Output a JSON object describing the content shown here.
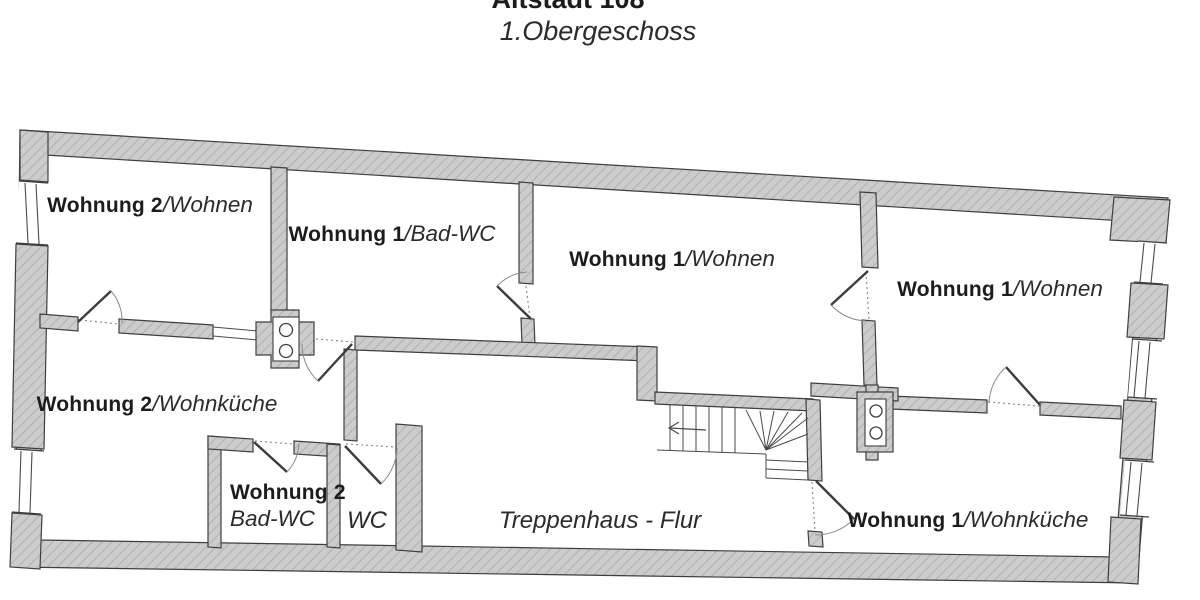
{
  "header": {
    "project_title": "Altstadt 108",
    "floor_title": "1.Obergeschoss"
  },
  "rooms": [
    {
      "id": "wohnung2-wohnen",
      "bold": "Wohnung 2",
      "italic": "/Wohnen"
    },
    {
      "id": "wohnung1-bad-wc",
      "bold": "Wohnung 1",
      "italic": "/Bad-WC"
    },
    {
      "id": "wohnung1-wohnen-mitte",
      "bold": "Wohnung 1",
      "italic": "/Wohnen"
    },
    {
      "id": "wohnung1-wohnen-rechts",
      "bold": "Wohnung 1",
      "italic": "/Wohnen"
    },
    {
      "id": "wohnung2-wohnkueche",
      "bold": "Wohnung 2",
      "italic": "/Wohnküche"
    },
    {
      "id": "wohnung2-bad-wc",
      "bold": "Wohnung 2",
      "italic": "Bad-WC"
    },
    {
      "id": "wc",
      "italic": "WC"
    },
    {
      "id": "treppenhaus-flur",
      "italic": "Treppenhaus - Flur"
    },
    {
      "id": "wohnung1-wohnkueche",
      "bold": "Wohnung 1",
      "italic": "/Wohnküche"
    }
  ],
  "symbols": {
    "stair_direction_arrow": "←",
    "chimney_count": "2",
    "window_count": "5"
  },
  "colors": {
    "wall_fill": "#cccccc",
    "wall_hatch": "#b0b0b0",
    "wall_stroke": "#3f3f3f",
    "text": "#1c1c1c",
    "background": "#ffffff"
  }
}
